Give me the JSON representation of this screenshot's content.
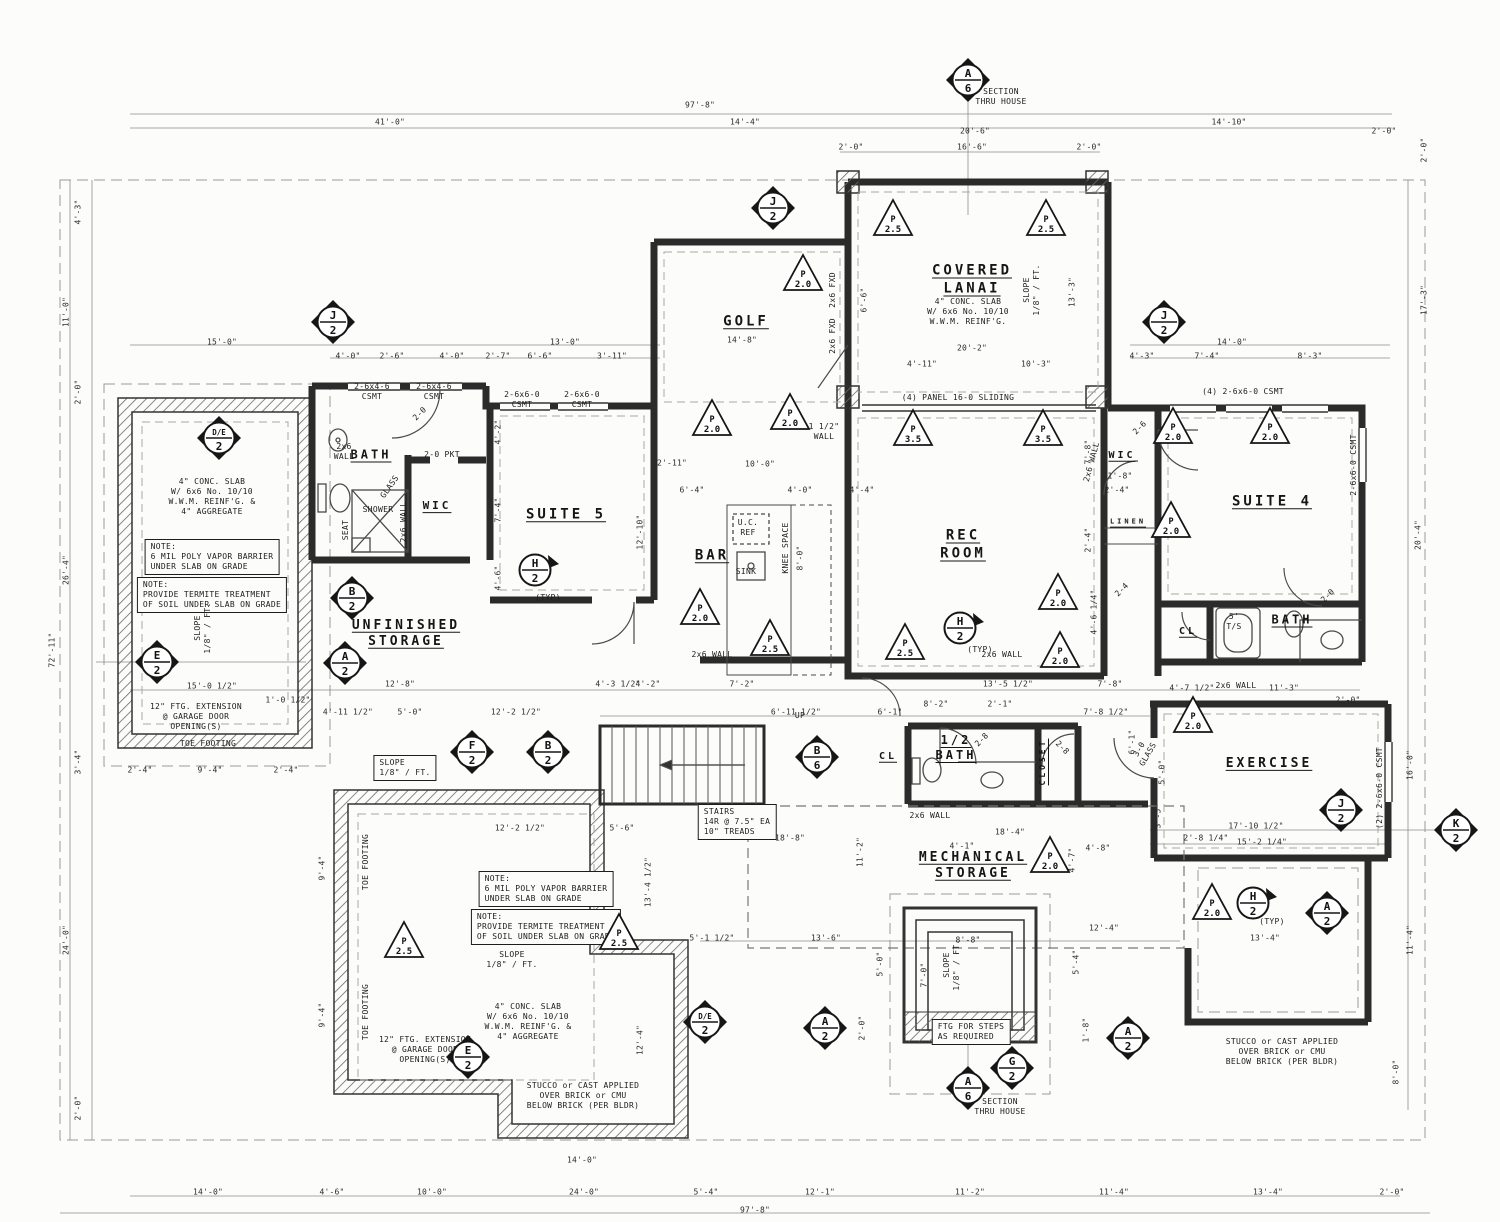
{
  "drawing": {
    "type": "architectural-floor-plan",
    "section_label": "SECTION THRU HOUSE",
    "ink": "#2b2b2b",
    "dim_color": "#555555",
    "paper": "#fcfcfa"
  },
  "rooms": [
    {
      "t": "GOLF",
      "x": 746,
      "y": 322
    },
    {
      "t": "COVERED\nLANAI",
      "x": 972,
      "y": 280
    },
    {
      "t": "BATH",
      "x": 371,
      "y": 455,
      "s": 12
    },
    {
      "t": "WIC",
      "x": 437,
      "y": 506,
      "s": 11
    },
    {
      "t": "SUITE 5",
      "x": 566,
      "y": 515
    },
    {
      "t": "BAR",
      "x": 712,
      "y": 556
    },
    {
      "t": "REC\nROOM",
      "x": 963,
      "y": 545
    },
    {
      "t": "WIC",
      "x": 1122,
      "y": 456,
      "s": 10
    },
    {
      "t": "SUITE 4",
      "x": 1272,
      "y": 502
    },
    {
      "t": "LINEN",
      "x": 1128,
      "y": 522,
      "s": 7
    },
    {
      "t": "CL",
      "x": 1188,
      "y": 632,
      "s": 10
    },
    {
      "t": "BATH",
      "x": 1292,
      "y": 620,
      "s": 12
    },
    {
      "t": "UNFINISHED\nSTORAGE",
      "x": 406,
      "y": 634,
      "s": 13
    },
    {
      "t": "CL",
      "x": 888,
      "y": 757,
      "s": 10
    },
    {
      "t": "1/2\nBATH",
      "x": 956,
      "y": 748,
      "s": 12
    },
    {
      "t": "CLOSET",
      "x": 1043,
      "y": 762,
      "s": 8,
      "r": -90
    },
    {
      "t": "EXERCISE",
      "x": 1269,
      "y": 764,
      "s": 13
    },
    {
      "t": "MECHANICAL\nSTORAGE",
      "x": 973,
      "y": 866,
      "s": 13
    }
  ],
  "notes": [
    {
      "t": "SECTION\nTHRU HOUSE",
      "x": 1001,
      "y": 97
    },
    {
      "t": "SECTION\nTHRU HOUSE",
      "x": 1000,
      "y": 1107
    },
    {
      "t": "4\" CONC. SLAB\nW/ 6x6 No. 10/10\nW.W.M. REINF'G. &\n4\" AGGREGATE",
      "x": 212,
      "y": 497
    },
    {
      "t": "NOTE:\n6 MIL POLY VAPOR BARRIER\nUNDER SLAB ON GRADE",
      "x": 212,
      "y": 557,
      "box": true
    },
    {
      "t": "NOTE:\nPROVIDE TERMITE TREATMENT\nOF SOIL UNDER SLAB ON GRADE",
      "x": 212,
      "y": 595,
      "box": true
    },
    {
      "t": "4\" CONC. SLAB\nW/ 6x6 No. 10/10\nW.W.M. REINF'G.",
      "x": 968,
      "y": 312
    },
    {
      "t": "SLOPE\n1/8\" / FT.",
      "x": 1032,
      "y": 290,
      "r": -90
    },
    {
      "t": "SLOPE\n1/8\" / FT.",
      "x": 203,
      "y": 628,
      "r": -90
    },
    {
      "t": "SLOPE\n1/8\" / FT.",
      "x": 405,
      "y": 768,
      "box": true
    },
    {
      "t": "SLOPE\n1/8\" / FT.",
      "x": 512,
      "y": 960
    },
    {
      "t": "SLOPE\n1/8\" / FT.",
      "x": 952,
      "y": 965,
      "r": -90
    },
    {
      "t": "NOTE:\n6 MIL POLY VAPOR BARRIER\nUNDER SLAB ON GRADE",
      "x": 546,
      "y": 889,
      "box": true
    },
    {
      "t": "NOTE:\nPROVIDE TERMITE TREATMENT\nOF SOIL UNDER SLAB ON GRADE",
      "x": 546,
      "y": 927,
      "box": true
    },
    {
      "t": "4\" CONC. SLAB\nW/ 6x6 No. 10/10\nW.W.M. REINF'G. &\n4\" AGGREGATE",
      "x": 528,
      "y": 1022
    },
    {
      "t": "12\" FTG. EXTENSION\n@ GARAGE DOOR\nOPENING(S)",
      "x": 196,
      "y": 717
    },
    {
      "t": "TOE FOOTING",
      "x": 208,
      "y": 744
    },
    {
      "t": "TOE FOOTING",
      "x": 366,
      "y": 862,
      "r": -90
    },
    {
      "t": "TOE FOOTING",
      "x": 366,
      "y": 1012,
      "r": -90
    },
    {
      "t": "12\" FTG. EXTENSION\n@ GARAGE DOOR\nOPENING(S)",
      "x": 425,
      "y": 1050
    },
    {
      "t": "STUCCO or CAST APPLIED\nOVER BRICK or CMU\nBELOW BRICK (PER BLDR)",
      "x": 583,
      "y": 1096
    },
    {
      "t": "STUCCO or CAST APPLIED\nOVER BRICK or CMU\nBELOW BRICK (PER BLDR)",
      "x": 1282,
      "y": 1052
    },
    {
      "t": "STAIRS\n14R @ 7.5\" EA\n10\" TREADS",
      "x": 737,
      "y": 822,
      "box": true
    },
    {
      "t": "FTG FOR STEPS\nAS REQUIRED",
      "x": 971,
      "y": 1032,
      "box": true
    },
    {
      "t": "(4) PANEL 16-0 SLIDING",
      "x": 958,
      "y": 398
    },
    {
      "t": "(4) 2-6x6-0 CSMT",
      "x": 1243,
      "y": 392
    },
    {
      "t": "2-6x4-6\nCSMT",
      "x": 372,
      "y": 392
    },
    {
      "t": "2-6x4-6\nCSMT",
      "x": 434,
      "y": 392
    },
    {
      "t": "2-6x6-0\nCSMT",
      "x": 522,
      "y": 400
    },
    {
      "t": "2-6x6-0\nCSMT",
      "x": 582,
      "y": 400
    },
    {
      "t": "2-0 PKT",
      "x": 442,
      "y": 455
    },
    {
      "t": "2x6\nWALL",
      "x": 344,
      "y": 452
    },
    {
      "t": "2x6 WALL",
      "x": 404,
      "y": 522,
      "r": -90
    },
    {
      "t": "2x6 WALL",
      "x": 712,
      "y": 655
    },
    {
      "t": "2x6 WALL",
      "x": 1002,
      "y": 655
    },
    {
      "t": "2x6 WALL",
      "x": 930,
      "y": 816
    },
    {
      "t": "2x6 WALL",
      "x": 1092,
      "y": 462,
      "r": -75
    },
    {
      "t": "2x6 WALL",
      "x": 1236,
      "y": 686
    },
    {
      "t": "U.C.\nREF",
      "x": 748,
      "y": 528
    },
    {
      "t": "SINK",
      "x": 746,
      "y": 572
    },
    {
      "t": "KNEE SPACE",
      "x": 786,
      "y": 548,
      "r": -90
    },
    {
      "t": "SHOWER",
      "x": 378,
      "y": 510
    },
    {
      "t": "SEAT",
      "x": 346,
      "y": 530,
      "r": -90
    },
    {
      "t": "GLASS",
      "x": 390,
      "y": 487,
      "r": -55
    },
    {
      "t": "5'\nT/S",
      "x": 1234,
      "y": 622
    },
    {
      "t": "UP",
      "x": 800,
      "y": 716
    },
    {
      "t": "(TYP)",
      "x": 548,
      "y": 598
    },
    {
      "t": "(TYP)",
      "x": 980,
      "y": 650
    },
    {
      "t": "(TYP)",
      "x": 1272,
      "y": 922
    },
    {
      "t": "1 1/2\"\nWALL",
      "x": 824,
      "y": 432
    },
    {
      "t": "2x6 FXD",
      "x": 833,
      "y": 290,
      "r": -90
    },
    {
      "t": "2x6 FXD",
      "x": 833,
      "y": 336,
      "r": -90
    },
    {
      "t": "3-0\nGLASS",
      "x": 1144,
      "y": 752,
      "r": -60
    },
    {
      "t": "(2) 2-6x6-0 CSMT",
      "x": 1380,
      "y": 788,
      "r": -90
    },
    {
      "t": "2-6x6-0 CSMT",
      "x": 1354,
      "y": 465,
      "r": -90
    },
    {
      "t": "2-0",
      "x": 420,
      "y": 414,
      "r": -45
    },
    {
      "t": "2-8",
      "x": 982,
      "y": 740,
      "r": -45
    },
    {
      "t": "2-8",
      "x": 1062,
      "y": 748,
      "r": 45
    },
    {
      "t": "2-6",
      "x": 1140,
      "y": 428,
      "r": -45
    },
    {
      "t": "2-0",
      "x": 1328,
      "y": 596,
      "r": -45
    },
    {
      "t": "2-4",
      "x": 1122,
      "y": 590,
      "r": -45
    },
    {
      "t": "CLOSET",
      "x": 0,
      "y": -100
    }
  ],
  "dims": [
    {
      "t": "97'-8\"",
      "x": 700,
      "y": 105
    },
    {
      "t": "41'-0\"",
      "x": 390,
      "y": 122
    },
    {
      "t": "14'-4\"",
      "x": 745,
      "y": 122
    },
    {
      "t": "20'-6\"",
      "x": 975,
      "y": 131
    },
    {
      "t": "16'-6\"",
      "x": 972,
      "y": 147
    },
    {
      "t": "2'-0\"",
      "x": 851,
      "y": 147
    },
    {
      "t": "2'-0\"",
      "x": 1089,
      "y": 147
    },
    {
      "t": "14'-10\"",
      "x": 1229,
      "y": 122
    },
    {
      "t": "2'-0\"",
      "x": 1384,
      "y": 131
    },
    {
      "t": "4'-3\"",
      "x": 78,
      "y": 212,
      "r": -90
    },
    {
      "t": "11'-0\"",
      "x": 66,
      "y": 312,
      "r": -90
    },
    {
      "t": "2'-0\"",
      "x": 78,
      "y": 392,
      "r": -90
    },
    {
      "t": "26'-4\"",
      "x": 66,
      "y": 570,
      "r": -90
    },
    {
      "t": "72'-11\"",
      "x": 52,
      "y": 650,
      "r": -90
    },
    {
      "t": "3'-4\"",
      "x": 78,
      "y": 762,
      "r": -90
    },
    {
      "t": "24'-0\"",
      "x": 66,
      "y": 940,
      "r": -90
    },
    {
      "t": "2'-0\"",
      "x": 78,
      "y": 1108,
      "r": -90
    },
    {
      "t": "2'-0\"",
      "x": 1424,
      "y": 150,
      "r": -90
    },
    {
      "t": "17'-3\"",
      "x": 1424,
      "y": 300,
      "r": -90
    },
    {
      "t": "20'-4\"",
      "x": 1418,
      "y": 535,
      "r": -90
    },
    {
      "t": "16'-0\"",
      "x": 1410,
      "y": 765,
      "r": -90
    },
    {
      "t": "11'-4\"",
      "x": 1410,
      "y": 940,
      "r": -90
    },
    {
      "t": "8'-0\"",
      "x": 1396,
      "y": 1072,
      "r": -90
    },
    {
      "t": "14'-0\"",
      "x": 208,
      "y": 1192
    },
    {
      "t": "4'-6\"",
      "x": 332,
      "y": 1192
    },
    {
      "t": "10'-0\"",
      "x": 432,
      "y": 1192
    },
    {
      "t": "24'-0\"",
      "x": 584,
      "y": 1192
    },
    {
      "t": "14'-0\"",
      "x": 582,
      "y": 1160
    },
    {
      "t": "5'-4\"",
      "x": 706,
      "y": 1192
    },
    {
      "t": "12'-1\"",
      "x": 820,
      "y": 1192
    },
    {
      "t": "11'-2\"",
      "x": 970,
      "y": 1192
    },
    {
      "t": "11'-4\"",
      "x": 1114,
      "y": 1192
    },
    {
      "t": "13'-4\"",
      "x": 1268,
      "y": 1192
    },
    {
      "t": "2'-0\"",
      "x": 1392,
      "y": 1192
    },
    {
      "t": "97'-8\"",
      "x": 755,
      "y": 1210
    },
    {
      "t": "15'-0\"",
      "x": 222,
      "y": 342
    },
    {
      "t": "13'-0\"",
      "x": 565,
      "y": 342
    },
    {
      "t": "4'-0\"",
      "x": 348,
      "y": 356
    },
    {
      "t": "2'-6\"",
      "x": 392,
      "y": 356
    },
    {
      "t": "4'-0\"",
      "x": 452,
      "y": 356
    },
    {
      "t": "2'-7\"",
      "x": 498,
      "y": 356
    },
    {
      "t": "6'-6\"",
      "x": 540,
      "y": 356
    },
    {
      "t": "3'-11\"",
      "x": 612,
      "y": 356
    },
    {
      "t": "14'-8\"",
      "x": 742,
      "y": 340
    },
    {
      "t": "20'-2\"",
      "x": 972,
      "y": 348
    },
    {
      "t": "4'-11\"",
      "x": 922,
      "y": 364
    },
    {
      "t": "10'-3\"",
      "x": 1036,
      "y": 364
    },
    {
      "t": "14'-0\"",
      "x": 1232,
      "y": 342
    },
    {
      "t": "4'-3\"",
      "x": 1142,
      "y": 356
    },
    {
      "t": "7'-4\"",
      "x": 1207,
      "y": 356
    },
    {
      "t": "8'-3\"",
      "x": 1310,
      "y": 356
    },
    {
      "t": "6'-6\"",
      "x": 864,
      "y": 300,
      "r": -90
    },
    {
      "t": "13'-3\"",
      "x": 1072,
      "y": 292,
      "r": -90
    },
    {
      "t": "4'-2\"",
      "x": 498,
      "y": 432,
      "r": -90
    },
    {
      "t": "7'-4\"",
      "x": 498,
      "y": 510,
      "r": -90
    },
    {
      "t": "4'-6\"",
      "x": 498,
      "y": 578,
      "r": -90
    },
    {
      "t": "12'-10\"",
      "x": 640,
      "y": 532,
      "r": -90
    },
    {
      "t": "2'-11\"",
      "x": 672,
      "y": 463
    },
    {
      "t": "8'-0\"",
      "x": 800,
      "y": 558,
      "r": -90
    },
    {
      "t": "7'-8\"",
      "x": 1088,
      "y": 452,
      "r": -90
    },
    {
      "t": "2'-4\"",
      "x": 1088,
      "y": 540,
      "r": -90
    },
    {
      "t": "4'-6 1/4\"",
      "x": 1094,
      "y": 612,
      "r": -90
    },
    {
      "t": "1'-8\"",
      "x": 1120,
      "y": 476
    },
    {
      "t": "2'-4\"",
      "x": 1117,
      "y": 490
    },
    {
      "t": "6'-4\"",
      "x": 692,
      "y": 490
    },
    {
      "t": "4'-0\"",
      "x": 800,
      "y": 490
    },
    {
      "t": "4'-4\"",
      "x": 862,
      "y": 490
    },
    {
      "t": "10'-0\"",
      "x": 760,
      "y": 464
    },
    {
      "t": "15'-0 1/2\"",
      "x": 212,
      "y": 686
    },
    {
      "t": "12'-8\"",
      "x": 400,
      "y": 684
    },
    {
      "t": "4'-3 1/2\"",
      "x": 618,
      "y": 684
    },
    {
      "t": "7'-2\"",
      "x": 742,
      "y": 684
    },
    {
      "t": "13'-5 1/2\"",
      "x": 1008,
      "y": 684
    },
    {
      "t": "7'-8\"",
      "x": 1110,
      "y": 684
    },
    {
      "t": "1'-0 1/2\"",
      "x": 288,
      "y": 700
    },
    {
      "t": "4'-11 1/2\"",
      "x": 348,
      "y": 712
    },
    {
      "t": "5'-0\"",
      "x": 410,
      "y": 712
    },
    {
      "t": "12'-2 1/2\"",
      "x": 516,
      "y": 712
    },
    {
      "t": "6'-11 1/2\"",
      "x": 796,
      "y": 712
    },
    {
      "t": "6'-1\"",
      "x": 890,
      "y": 712
    },
    {
      "t": "8'-2\"",
      "x": 936,
      "y": 704
    },
    {
      "t": "2'-1\"",
      "x": 1000,
      "y": 704
    },
    {
      "t": "7'-8 1/2\"",
      "x": 1106,
      "y": 712
    },
    {
      "t": "4'-7 1/2\"",
      "x": 1192,
      "y": 688
    },
    {
      "t": "11'-3\"",
      "x": 1284,
      "y": 688
    },
    {
      "t": "2'-0\"",
      "x": 1348,
      "y": 700
    },
    {
      "t": "4'-1\"",
      "x": 962,
      "y": 846
    },
    {
      "t": "4'-8\"",
      "x": 1098,
      "y": 848
    },
    {
      "t": "18'-4\"",
      "x": 1010,
      "y": 832
    },
    {
      "t": "18'-8\"",
      "x": 790,
      "y": 838
    },
    {
      "t": "6'-1\"",
      "x": 1132,
      "y": 742,
      "r": -90
    },
    {
      "t": "2'-4\"",
      "x": 140,
      "y": 770
    },
    {
      "t": "9'-4\"",
      "x": 210,
      "y": 770
    },
    {
      "t": "2'-4\"",
      "x": 286,
      "y": 770
    },
    {
      "t": "4'-2\"",
      "x": 648,
      "y": 684
    },
    {
      "t": "12'-2 1/2\"",
      "x": 520,
      "y": 828
    },
    {
      "t": "5'-6\"",
      "x": 622,
      "y": 828
    },
    {
      "t": "13'-4 1/2\"",
      "x": 648,
      "y": 882,
      "r": -90
    },
    {
      "t": "12'-4\"",
      "x": 640,
      "y": 1040,
      "r": -90
    },
    {
      "t": "9'-4\"",
      "x": 322,
      "y": 868,
      "r": -90
    },
    {
      "t": "9'-4\"",
      "x": 322,
      "y": 1015,
      "r": -90
    },
    {
      "t": "17'-10 1/2\"",
      "x": 1256,
      "y": 826
    },
    {
      "t": "15'-2 1/4\"",
      "x": 1262,
      "y": 842
    },
    {
      "t": "2'-8 1/4\"",
      "x": 1206,
      "y": 838
    },
    {
      "t": "5'-0\"",
      "x": 1162,
      "y": 772,
      "r": -90
    },
    {
      "t": "3'-5\"",
      "x": 1158,
      "y": 816,
      "r": -90
    },
    {
      "t": "11'-2\"",
      "x": 860,
      "y": 852,
      "r": -90
    },
    {
      "t": "4'-7\"",
      "x": 1072,
      "y": 860,
      "r": -90
    },
    {
      "t": "5'-1 1/2\"",
      "x": 712,
      "y": 938
    },
    {
      "t": "13'-6\"",
      "x": 826,
      "y": 938
    },
    {
      "t": "8'-8\"",
      "x": 968,
      "y": 940
    },
    {
      "t": "12'-4\"",
      "x": 1104,
      "y": 928
    },
    {
      "t": "13'-4\"",
      "x": 1265,
      "y": 938
    },
    {
      "t": "5'-0\"",
      "x": 880,
      "y": 964,
      "r": -90
    },
    {
      "t": "5'-4\"",
      "x": 1076,
      "y": 962,
      "r": -90
    },
    {
      "t": "7'-0\"",
      "x": 924,
      "y": 975,
      "r": -90
    },
    {
      "t": "2'-0\"",
      "x": 862,
      "y": 1028,
      "r": -90
    },
    {
      "t": "1'-8\"",
      "x": 1086,
      "y": 1030,
      "r": -90
    }
  ],
  "markers": {
    "diamonds": [
      {
        "l": "A",
        "n": "6",
        "x": 968,
        "y": 80
      },
      {
        "l": "J",
        "n": "2",
        "x": 773,
        "y": 208
      },
      {
        "l": "J",
        "n": "2",
        "x": 333,
        "y": 322
      },
      {
        "l": "J",
        "n": "2",
        "x": 1164,
        "y": 322
      },
      {
        "l": "D/E",
        "n": "2",
        "x": 219,
        "y": 438
      },
      {
        "l": "B",
        "n": "2",
        "x": 352,
        "y": 598
      },
      {
        "l": "A",
        "n": "2",
        "x": 345,
        "y": 663
      },
      {
        "l": "E",
        "n": "2",
        "x": 157,
        "y": 662
      },
      {
        "l": "F",
        "n": "2",
        "x": 472,
        "y": 752
      },
      {
        "l": "B",
        "n": "2",
        "x": 548,
        "y": 752
      },
      {
        "l": "B",
        "n": "6",
        "x": 817,
        "y": 757
      },
      {
        "l": "D/E",
        "n": "2",
        "x": 705,
        "y": 1022
      },
      {
        "l": "E",
        "n": "2",
        "x": 468,
        "y": 1057
      },
      {
        "l": "A",
        "n": "2",
        "x": 825,
        "y": 1028
      },
      {
        "l": "G",
        "n": "2",
        "x": 1012,
        "y": 1068
      },
      {
        "l": "A",
        "n": "6",
        "x": 968,
        "y": 1088
      },
      {
        "l": "A",
        "n": "2",
        "x": 1128,
        "y": 1038
      },
      {
        "l": "A",
        "n": "2",
        "x": 1327,
        "y": 913
      },
      {
        "l": "J",
        "n": "2",
        "x": 1341,
        "y": 810
      },
      {
        "l": "K",
        "n": "2",
        "x": 1456,
        "y": 830
      }
    ],
    "circles": [
      {
        "l": "H",
        "n": "2",
        "x": 537,
        "y": 570
      },
      {
        "l": "H",
        "n": "2",
        "x": 962,
        "y": 628
      },
      {
        "l": "H",
        "n": "2",
        "x": 1255,
        "y": 903
      }
    ],
    "triangles": [
      {
        "l": "P",
        "n": "2.0",
        "x": 712,
        "y": 418
      },
      {
        "l": "P",
        "n": "2.0",
        "x": 790,
        "y": 412
      },
      {
        "l": "P",
        "n": "2.0",
        "x": 803,
        "y": 273
      },
      {
        "l": "P",
        "n": "2.5",
        "x": 893,
        "y": 218
      },
      {
        "l": "P",
        "n": "2.5",
        "x": 1046,
        "y": 218
      },
      {
        "l": "P",
        "n": "3.5",
        "x": 913,
        "y": 428
      },
      {
        "l": "P",
        "n": "3.5",
        "x": 1043,
        "y": 428
      },
      {
        "l": "P",
        "n": "2.0",
        "x": 700,
        "y": 607
      },
      {
        "l": "P",
        "n": "2.5",
        "x": 770,
        "y": 638
      },
      {
        "l": "P",
        "n": "2.5",
        "x": 905,
        "y": 642
      },
      {
        "l": "P",
        "n": "2.0",
        "x": 1058,
        "y": 592
      },
      {
        "l": "P",
        "n": "2.0",
        "x": 1060,
        "y": 650
      },
      {
        "l": "P",
        "n": "2.0",
        "x": 1173,
        "y": 426
      },
      {
        "l": "P",
        "n": "2.0",
        "x": 1270,
        "y": 426
      },
      {
        "l": "P",
        "n": "2.0",
        "x": 1171,
        "y": 520
      },
      {
        "l": "P",
        "n": "2.0",
        "x": 1193,
        "y": 715
      },
      {
        "l": "P",
        "n": "2.0",
        "x": 1050,
        "y": 855
      },
      {
        "l": "P",
        "n": "2.0",
        "x": 1212,
        "y": 902
      },
      {
        "l": "P",
        "n": "2.5",
        "x": 404,
        "y": 940
      },
      {
        "l": "P",
        "n": "2.5",
        "x": 619,
        "y": 932
      }
    ]
  }
}
